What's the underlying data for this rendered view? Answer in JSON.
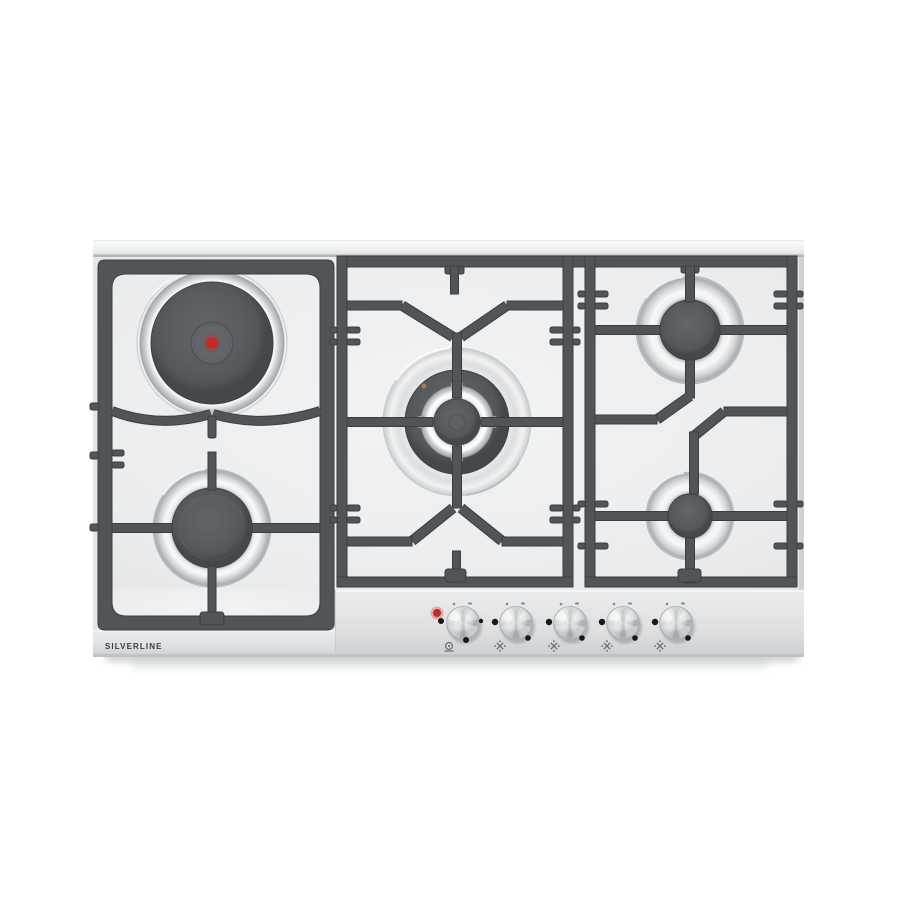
{
  "meta": {
    "description": "Product photo of a stainless-steel built-in cooktop with five cooking zones on a white background"
  },
  "brand": {
    "label": "SILVERLINE"
  },
  "cooktop": {
    "zones": [
      {
        "name": "electric-hotplate",
        "position": "top-left",
        "type": "electric",
        "indicator": "red center dot"
      },
      {
        "name": "gas-burner",
        "position": "bottom-left",
        "type": "gas"
      },
      {
        "name": "wok-gas-burner",
        "position": "center",
        "type": "gas, large triple-ring"
      },
      {
        "name": "gas-burner",
        "position": "top-right",
        "type": "gas"
      },
      {
        "name": "gas-burner",
        "position": "bottom-right",
        "type": "gas"
      }
    ],
    "controls": {
      "knob_count": 5,
      "knobs": [
        {
          "name": "knob-electric-plate",
          "icon": "hotplate-icon",
          "indicator": "red-led-on"
        },
        {
          "name": "knob-gas-2",
          "icon": "gas-burner-icon"
        },
        {
          "name": "knob-gas-3",
          "icon": "gas-burner-icon"
        },
        {
          "name": "knob-gas-4",
          "icon": "gas-burner-icon"
        },
        {
          "name": "knob-gas-5",
          "icon": "gas-burner-icon"
        }
      ]
    }
  },
  "colors": {
    "background": "#ffffff",
    "surface": "#eef0f2",
    "panel": "#e2e4e6",
    "grate": "#515559",
    "grate_edge": "#3b3e41",
    "burner_cap": "#55595d",
    "stainless_light": "#f5f6f7",
    "stainless_dark": "#aaadaf",
    "indicator_red": "#c62828",
    "brand_text": "#3a3d40"
  }
}
